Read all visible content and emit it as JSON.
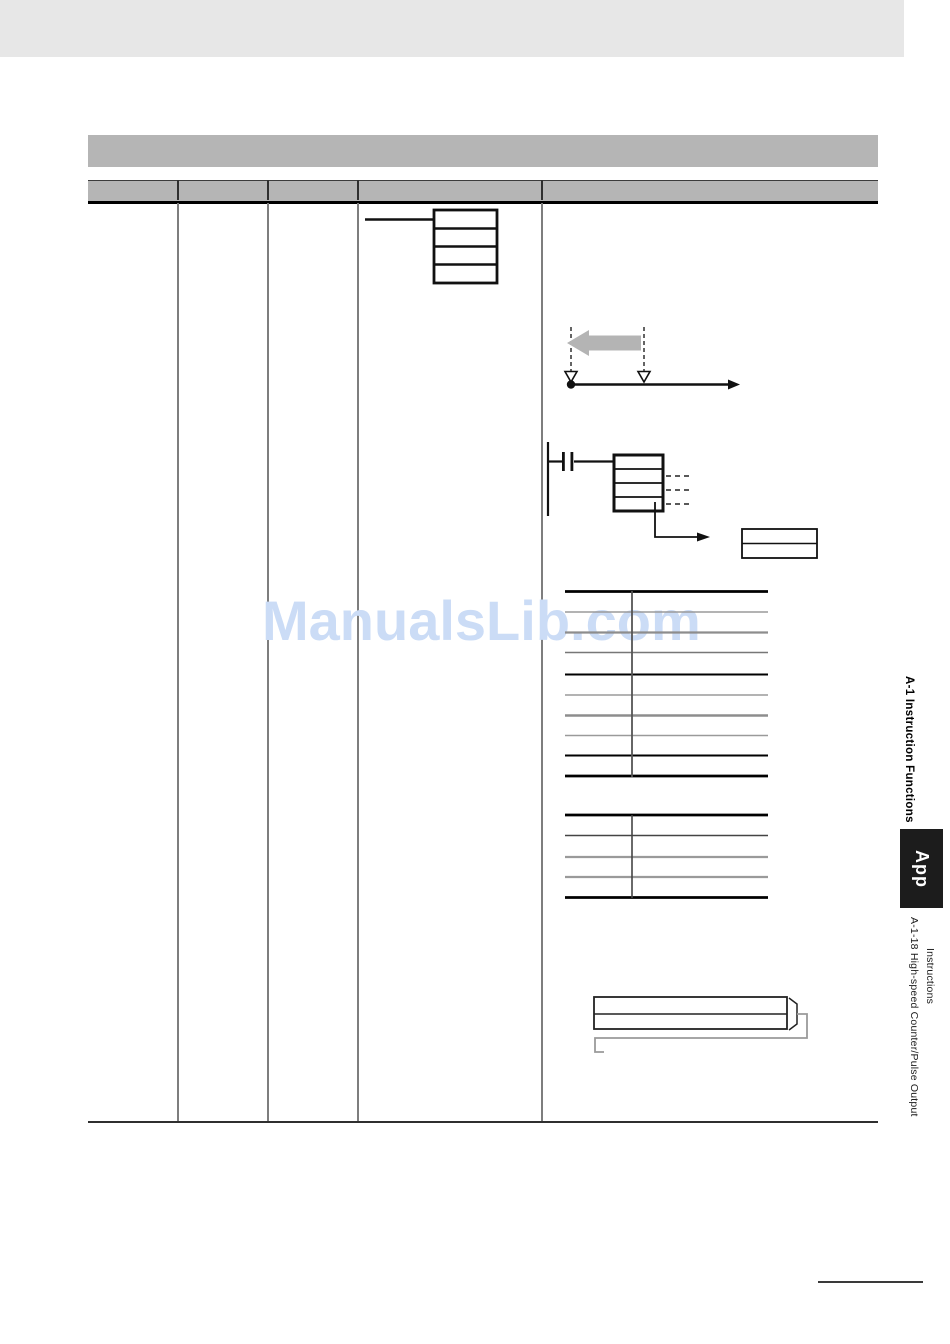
{
  "watermark": {
    "text": "ManualsLib.com",
    "color": "#cbdcf6"
  },
  "sidebar": {
    "section_tab": "A-1 Instruction Functions",
    "app_badge": "App",
    "subsection_line1": "A-1-18  High-speed Counter/Pulse Output",
    "subsection_line2": "Instructions"
  },
  "colors": {
    "top_band": "#e7e7e7",
    "section_bar_gray": "#b5b5b5",
    "table_header_gray": "#b5b5b5",
    "watermark_blue": "#cbdcf6",
    "diagram_arrow_gray": "#b4b4b4",
    "app_badge_black": "#1c1c1c"
  },
  "icons": {
    "range_arrow": "left-gray-arrow-icon",
    "timeline_markers": "open-triangle-markers",
    "ladder_contact": "normally-open-contact-icon"
  }
}
